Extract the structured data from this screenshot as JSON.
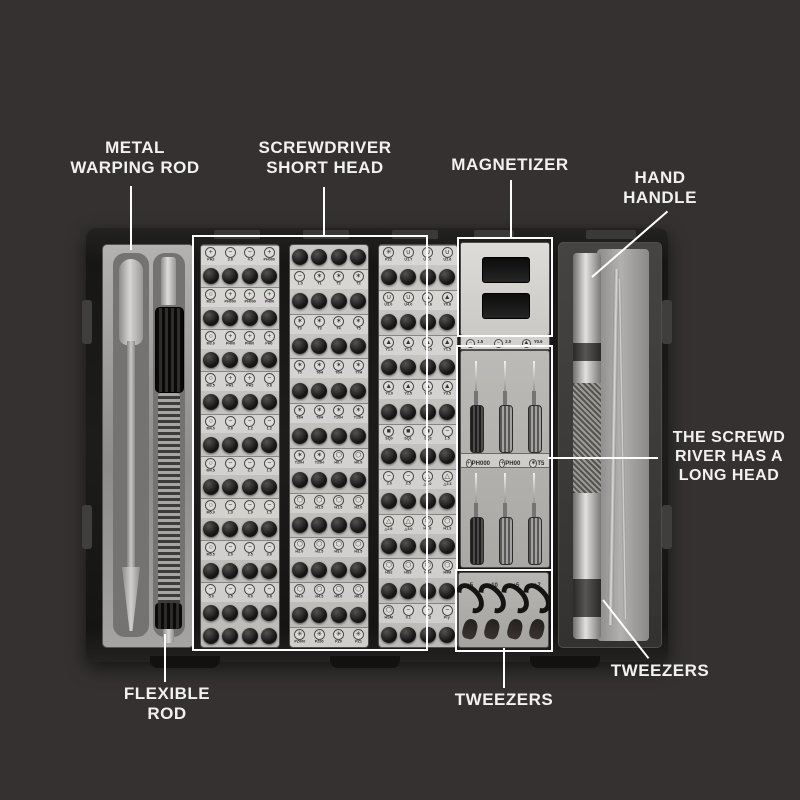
{
  "colors": {
    "background": "#353131",
    "callout_text": "#f2f1ef",
    "callout_line": "#ffffff",
    "tray_light_gray": "#c6c4c1",
    "bit_dark": "#191919",
    "case_dark": "#1b1b1b"
  },
  "callouts": {
    "metal_warping_rod": "METAL\nWARPING ROD",
    "screwdriver_short_head": "SCREWDRIVER\nSHORT HEAD",
    "magnetizer": "MAGNETIZER",
    "hand_handle": "HAND\nHANDLE",
    "long_head_note": "THE SCREWD\nRIVER HAS A\nLONG HEAD",
    "tweezers_right": "TWEEZERS",
    "tweezers_center": "TWEEZERS",
    "flexible_rod": "FLEXIBLE\nROD"
  },
  "kit": {
    "bit_columns": [
      {
        "start": "labels",
        "trailing_bit_rows": 1,
        "label_rows": [
          [
            "PH2",
            "3.8",
            "4.5",
            "PH000"
          ],
          [
            "M2.5",
            "PH000",
            "PH000",
            "PH00"
          ],
          [
            "M3.0",
            "PH00",
            "PH00",
            "PH0"
          ],
          [
            "M3.5",
            "PH1",
            "PH2",
            "0.8"
          ],
          [
            "M4.0",
            "0.8",
            "1.2",
            "1.2"
          ],
          [
            "M4.5",
            "1.5",
            "2.0",
            "1.0"
          ],
          [
            "M5.0",
            "1.3",
            "1.9",
            "1.5"
          ],
          [
            "M5.5",
            "2.0",
            "2.5",
            "3.0"
          ],
          [
            "5.0",
            "3.5",
            "4.0",
            "0.8"
          ]
        ]
      },
      {
        "start": "bits",
        "trailing_bit_rows": 0,
        "label_rows": [
          [
            "1.0",
            "T1",
            "T2",
            "T2"
          ],
          [
            "T3",
            "T3",
            "T4",
            "T5"
          ],
          [
            "T5",
            "T6H",
            "T6H",
            "T7H"
          ],
          [
            "T8H",
            "T9H",
            "T10H",
            "T15H"
          ],
          [
            "T20H",
            "T25H",
            "H0.7",
            "H0.9"
          ],
          [
            "H1.3",
            "H1.5",
            "H1.5",
            "H2.0"
          ],
          [
            "H2.0",
            "H2.5",
            "H3.0",
            "H3.5"
          ],
          [
            "H4.0",
            "H4.5",
            "H5.0",
            "H6.0"
          ],
          [
            "PZ000",
            "PZ00",
            "PZ0",
            "PZ1"
          ]
        ]
      },
      {
        "start": "labels",
        "trailing_bit_rows": 0,
        "label_rows": [
          [
            "PZ2",
            "U1.7",
            "U2.0",
            "U2.6"
          ],
          [
            "U3.0",
            "U4.0",
            "Y0.6",
            "Y0.8"
          ],
          [
            "Y1.0",
            "Y1.0",
            "Y1.5",
            "Y1.5"
          ],
          [
            "Y2.0",
            "Y2.5",
            "Y3.0",
            "Y3.5"
          ],
          [
            "SQ0",
            "SQ1",
            "SQ2",
            "1.5"
          ],
          [
            "2.0",
            "2.5",
            "△2.0",
            "△2.3"
          ],
          [
            "△2.6",
            "△3.0",
            "H0.8",
            "H1.3"
          ],
          [
            "HS2",
            "HS3",
            "HS4",
            "H9M"
          ],
          [
            "HSM",
            "0.1",
            "0.3",
            "Pry"
          ]
        ]
      }
    ],
    "size_strip": [
      "1.5",
      "2.0",
      "Y0.6"
    ],
    "driver_labels": [
      "PH000",
      "PH00",
      "T5"
    ],
    "driver_rows": 2,
    "drivers_per_row": 3,
    "tweezer_head_labels": [
      "+5",
      "+10",
      "+5",
      "+7"
    ],
    "hook_count": 4,
    "small_head_count": 4
  }
}
